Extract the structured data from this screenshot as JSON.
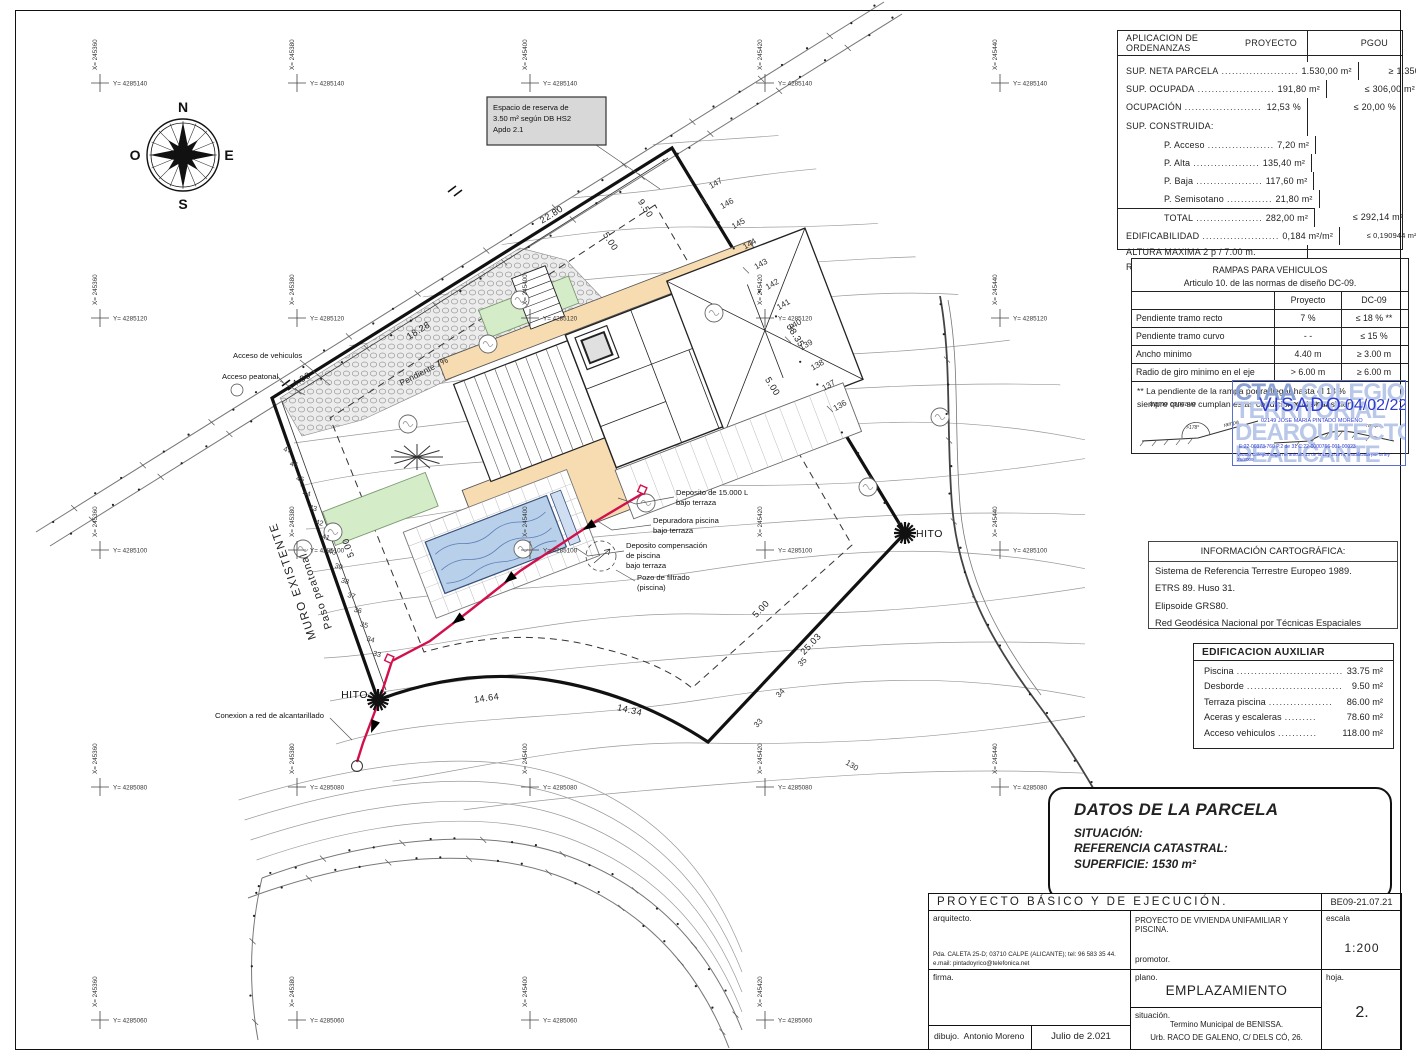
{
  "plan": {
    "compass": {
      "n": "N",
      "e": "E",
      "s": "S",
      "o": "O"
    },
    "grid": {
      "x_labels": [
        "X= 245360",
        "X= 245380",
        "X= 245400",
        "X= 245420",
        "X= 245440"
      ],
      "y_labels": [
        "Y= 4285140",
        "Y= 4285120",
        "Y= 4285100",
        "Y= 4285080",
        "Y= 4285060"
      ]
    },
    "contour_labels_ne": [
      "147",
      "146",
      "145",
      "144",
      "143",
      "142",
      "141",
      "140",
      "139",
      "138",
      "137",
      "136"
    ],
    "contour_labels_w": [
      "47",
      "46",
      "45",
      "44",
      "43",
      "42",
      "41",
      "40",
      "39",
      "38",
      "37",
      "36",
      "35",
      "34",
      "33"
    ],
    "contour_labels_se": [
      "35",
      "34",
      "33",
      "130"
    ],
    "dimensions": [
      "22.80",
      "18.28",
      "4.00",
      "9.50",
      "5.00",
      "38.35",
      "5.00",
      "25.03",
      "5.00",
      "14.64",
      "14.34",
      "5.00"
    ],
    "annotations": {
      "espacio_reserva": [
        "Espacio de reserva de",
        "3.50 m² según DB HS2",
        "Apdo 2.1"
      ],
      "muro_existente": "MURO EXISTENTE",
      "paso_peatonal": "Paso peatonal",
      "acceso_vehiculos": "Acceso de vehiculos",
      "acceso_peatonal": "Acceso peatonal",
      "pendiente": "Pendiente 7%",
      "hito": "HITO",
      "conexion": "Conexion a red de alcantarillado",
      "deposito": [
        "Deposito de 15.000 L",
        "bajo terraza"
      ],
      "depuradora": [
        "Depuradora piscina",
        "bajo terraza"
      ],
      "deposito_comp": [
        "Deposito compensación",
        "de piscina",
        "bajo terraza"
      ],
      "pozo": [
        "Pozo de filtrado",
        "(piscina)"
      ]
    }
  },
  "ordenanzas": {
    "title": "APLICACION DE ORDENANZAS",
    "col_proyecto": "PROYECTO",
    "col_pgou": "PGOU",
    "rows": [
      {
        "label": "SUP. NETA PARCELA",
        "dots": "......................",
        "proyecto": "1.530,00 m²",
        "pgou": "≥ 1.350,00 m²"
      },
      {
        "label": "SUP. OCUPADA",
        "dots": "......................",
        "proyecto": "191,80 m²",
        "pgou": "≤ 306,00 m²"
      },
      {
        "label": "OCUPACIÓN",
        "dots": "......................",
        "proyecto": "12,53 %",
        "pgou": "≤ 20,00 %"
      },
      {
        "label": "P. Acceso",
        "dots": "...................",
        "proyecto": "7,20 m²",
        "pgou": ""
      },
      {
        "label": "P. Alta",
        "dots": "...................",
        "proyecto": "135,40 m²",
        "pgou": ""
      },
      {
        "label": "P. Baja",
        "dots": "...................",
        "proyecto": "117,60 m²",
        "pgou": ""
      },
      {
        "label": "P. Semisotano",
        "dots": ".............",
        "proyecto": "21,80 m²",
        "pgou": ""
      },
      {
        "label": "TOTAL",
        "dots": "...................",
        "proyecto": "282,00 m²",
        "pgou": "≤ 292,14 m²"
      },
      {
        "label": "EDIFICABILIDAD",
        "dots": "......................",
        "proyecto": "0,184 m²/m²",
        "pgou": "≤ 0,190944 m²/m²"
      }
    ],
    "sup_construida": "SUP. CONSTRUIDA:",
    "altura": "ALTURA MAXIMA     2 p  / 7.00 m.",
    "retranqueos": "Retranqueos según planos"
  },
  "rampas": {
    "title": "RAMPAS PARA VEHICULOS",
    "subtitle": "Articulo 10. de  las normas de diseño  DC-09.",
    "col1": "Proyecto",
    "col2": "DC-09",
    "rows": [
      {
        "label": "Pendiente tramo recto",
        "proyecto": "7 %",
        "dc09": "≤ 18 % **"
      },
      {
        "label": "Pendiente tramo curvo",
        "proyecto": "- -",
        "dc09": "≤ 15 %"
      },
      {
        "label": "Ancho minimo",
        "proyecto": "4.40 m",
        "dc09": "≥ 3.00 m"
      },
      {
        "label": "Radio de giro minimo en el eje",
        "proyecto": "> 6.00 m",
        "dc09": "≥ 6.00 m"
      }
    ],
    "note1": "** La pendiente de la rampa podra llegar hasta el 18 %",
    "note2": "siempre que se cumplan  estas condiciones de transicion",
    "diagram_left": "tramo  concavo",
    "diagram_right": "tramo  convexo",
    "rampa": "rampa",
    "angle": ">178°"
  },
  "stamp": {
    "wm1_dark": "CTAA",
    "wm1_light": "COLEGIO",
    "wm2": "TERRITORIAL",
    "wm3": "DEARQUITECTOS",
    "wm4": "DEALICANTE",
    "visado": "VISADO",
    "fecha": "04/02/22",
    "colegiado": "02149 JOSE MARIA PINTADO MORENO",
    "refs": "E:22-00373-760      P.2 de 31      C:22-0000766-001-00023",
    "legal": "Visado Colegial según el articulo 13 de la Ley 2/1974, modificada por la ley 25/2009",
    "accent": "#2f3bd0"
  },
  "carto": {
    "title": "INFORMACIÓN CARTOGRÁFICA:",
    "lines": [
      "Sistema de Referencia Terrestre Europeo 1989.",
      "ETRS 89. Huso 31.",
      "Elipsoide GRS80.",
      "Red Geodésica Nacional por Técnicas Espaciales"
    ]
  },
  "auxiliar": {
    "title": "EDIFICACION AUXILIAR",
    "rows": [
      {
        "label": "Piscina",
        "dots": "..............................",
        "value": "33.75 m²"
      },
      {
        "label": "Desborde",
        "dots": "...........................",
        "value": "9.50 m²"
      },
      {
        "label": "Terraza piscina",
        "dots": "..................",
        "value": "86.00 m²"
      },
      {
        "label": "Aceras y escaleras",
        "dots": ".........",
        "value": "78.60 m²"
      },
      {
        "label": "Acceso vehiculos",
        "dots": "...........",
        "value": "118.00 m²"
      }
    ]
  },
  "datos": {
    "title": "DATOS DE LA PARCELA",
    "situacion": "SITUACIÓN:",
    "referencia": "REFERENCIA CATASTRAL:",
    "superficie": "SUPERFICIE: 1530 m²"
  },
  "titleblock": {
    "header": "PROYECTO  BÁSICO  Y  DE  EJECUCIÓN.",
    "code": "BE09-21.07.21",
    "arquitecto_label": "arquitecto.",
    "address1": "Pda. CALETA 25-D; 03710 CALPE (ALICANTE); tel: 96 583 35 44.",
    "address2": "e.mail:  pintadoyrico@telefonica.net",
    "proyecto": "PROYECTO DE VIVIENDA UNIFAMILIAR Y PISCINA.",
    "promotor_label": "promotor.",
    "escala_label": "escala",
    "escala": "1:200",
    "firma_label": "firma.",
    "plano_label": "plano.",
    "plano": "EMPLAZAMIENTO",
    "hoja_label": "hoja.",
    "hoja": "2.",
    "situacion_label": "situación.",
    "situacion1": "Termino Municipal de BENISSA.",
    "situacion2": "Urb. RACO DE GALENO, C/ DELS CÓ, 26.",
    "dibujo_label": "dibujo.",
    "dibujo": "Antonio Moreno",
    "fecha": "Julio de 2.021"
  }
}
